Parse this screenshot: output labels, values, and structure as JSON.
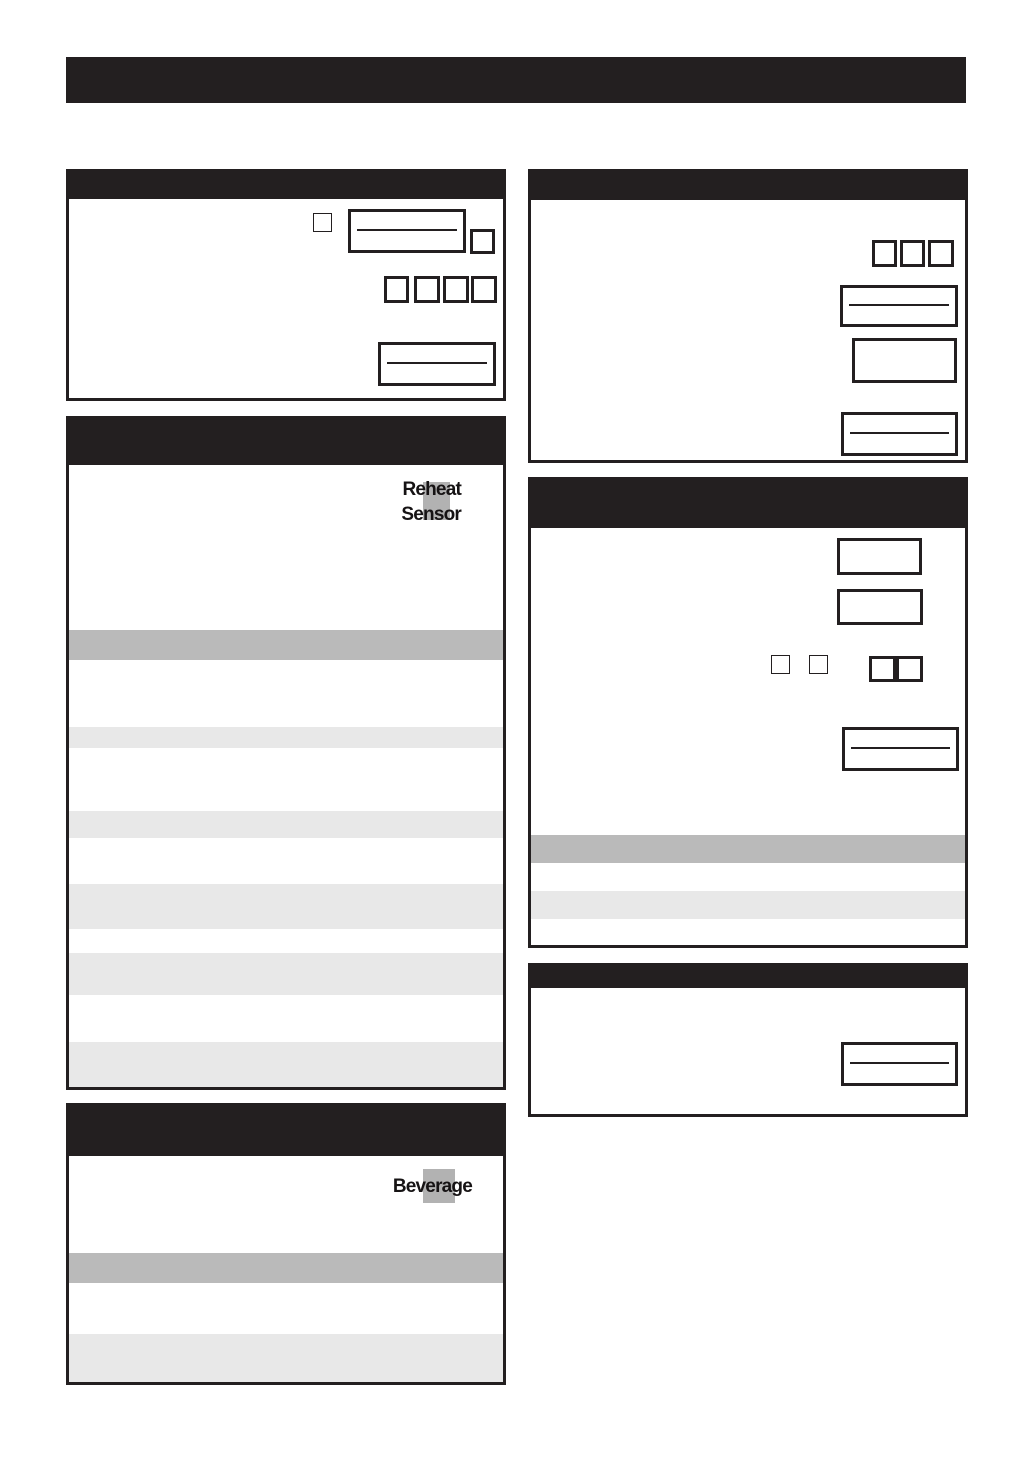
{
  "labels": {
    "reheat_sensor_key": {
      "line1": "Reheat",
      "line2": "Sensor"
    },
    "beverage_key": {
      "label": "Beverage"
    }
  },
  "colors": {
    "ink_black": "#231f20",
    "key_highlight_gray": "#b2b2b2",
    "row_stripe_dark": "#bababa",
    "row_stripe_light": "#e8e8e8",
    "paper": "#ffffff"
  }
}
